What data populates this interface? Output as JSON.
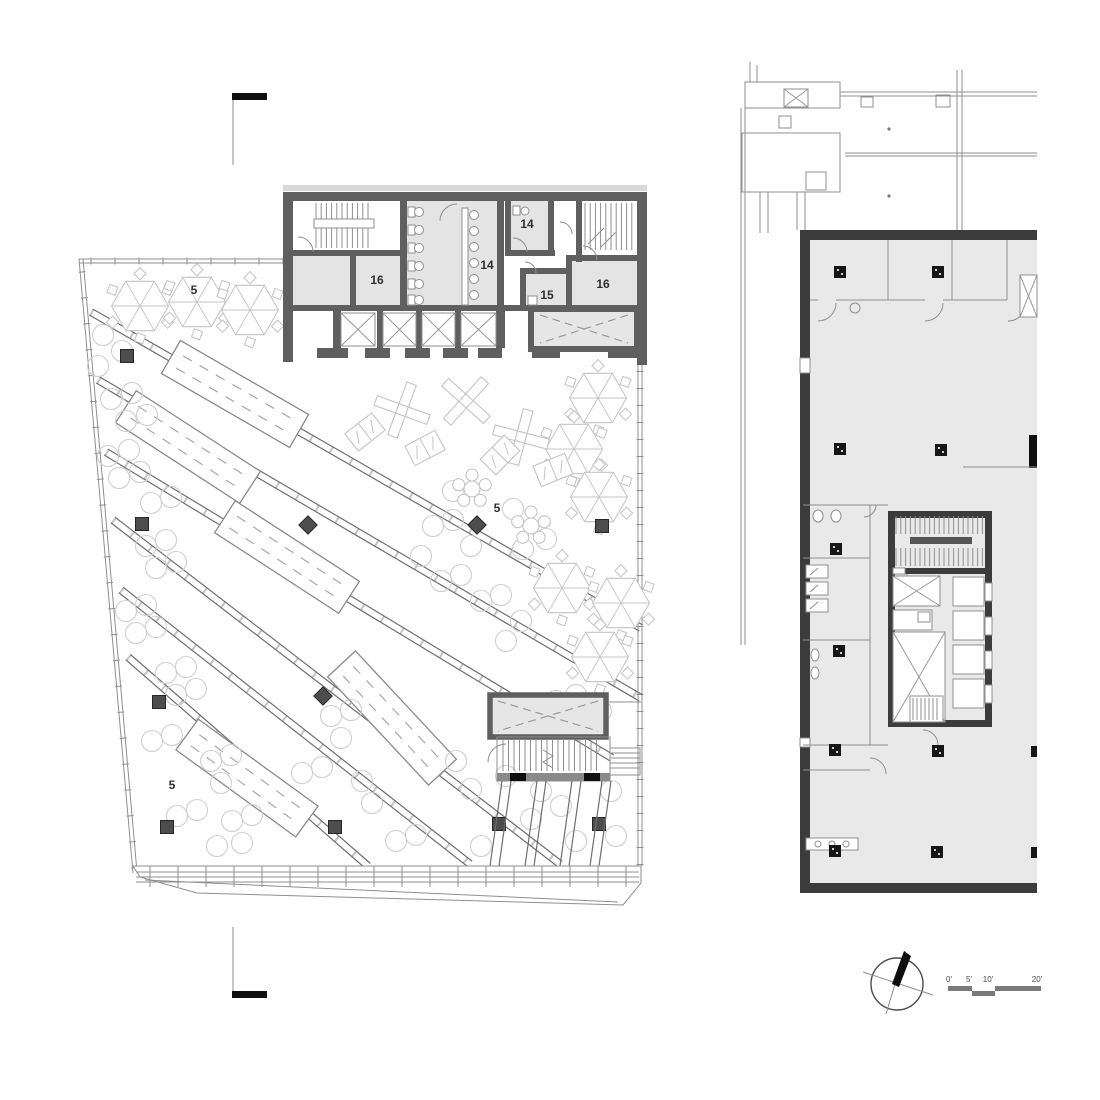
{
  "drawing": {
    "room_labels": {
      "open_office_upper": "5",
      "open_office_center": "5",
      "open_office_lower": "5",
      "restrooms_main": "14",
      "restroom_small": "14",
      "room_15": "15",
      "room_16_west": "16",
      "room_16_east": "16"
    },
    "scale_bar": {
      "tick_0": "0'",
      "tick_5": "5'",
      "tick_10": "10'",
      "tick_20": "20'"
    },
    "colors": {
      "heavy_wall": "#3c3c3c",
      "core_wall": "#5f5f5f",
      "room_fill": "#e4e4e4",
      "floor_fill": "#e9e9e9",
      "thin_line": "#8f8f8f",
      "furniture_line": "#c4c4c4",
      "label_text": "#2f2f2f"
    }
  }
}
